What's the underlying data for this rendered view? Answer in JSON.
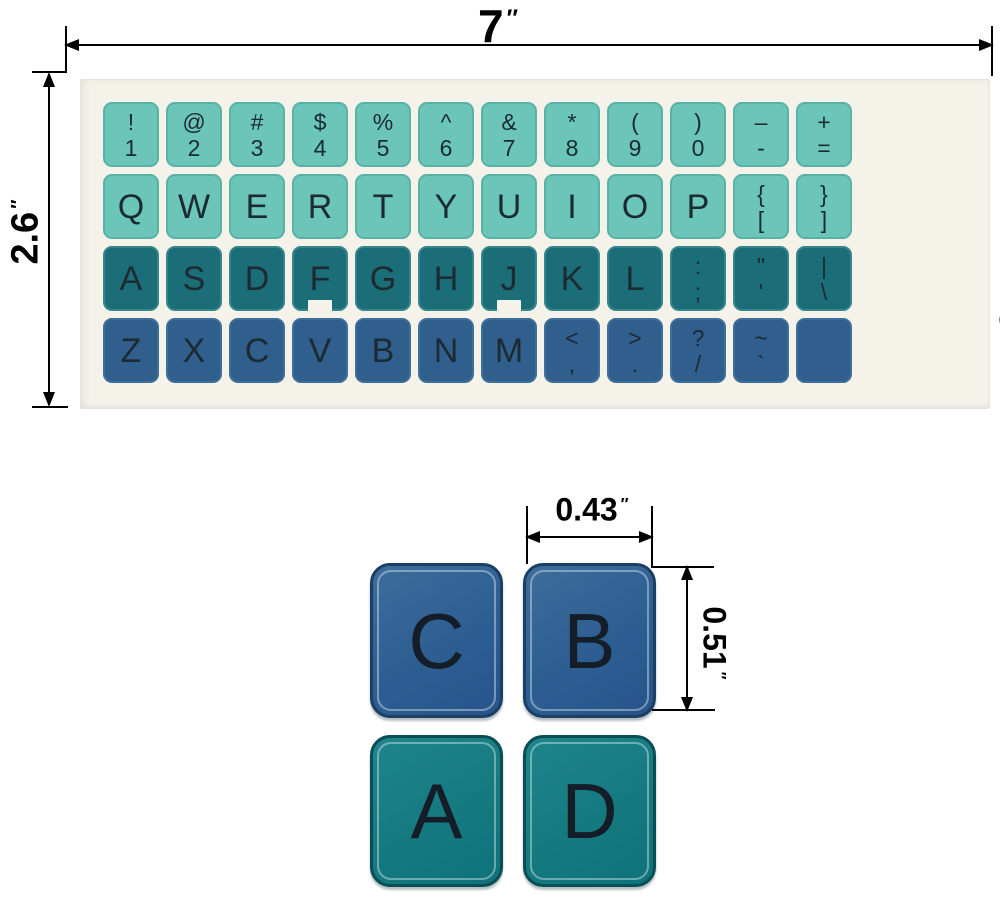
{
  "colors": {
    "sheet_bg": "#f5f2ea",
    "row_light": "#6cc5b9",
    "row_light_border": "#58b2a6",
    "row_dark": "#1b6d78",
    "row_dark_border": "#35858e",
    "row_blue": "#315f8d",
    "row_blue_border": "#3e6e9a",
    "big_blue": "#2d5e92",
    "big_blue_border": "#1c3f63",
    "big_teal": "#157a80",
    "big_teal_border": "#0b4d55",
    "legend_color": "#1c2a31"
  },
  "dimensions": {
    "sheet_width": {
      "value": "7",
      "unit": "″"
    },
    "sheet_height": {
      "value": "2.6",
      "unit": "″"
    },
    "key_width": {
      "value": "0.43",
      "unit": "″"
    },
    "key_height": {
      "value": "0.51",
      "unit": "″"
    }
  },
  "sticker_sheet": {
    "language_label": "English",
    "rows": [
      {
        "style": "light",
        "keys": [
          {
            "top": "!",
            "bottom": "1"
          },
          {
            "top": "@",
            "bottom": "2"
          },
          {
            "top": "#",
            "bottom": "3"
          },
          {
            "top": "$",
            "bottom": "4"
          },
          {
            "top": "%",
            "bottom": "5"
          },
          {
            "top": "^",
            "bottom": "6"
          },
          {
            "top": "&",
            "bottom": "7"
          },
          {
            "top": "*",
            "bottom": "8"
          },
          {
            "top": "(",
            "bottom": "9"
          },
          {
            "top": ")",
            "bottom": "0"
          },
          {
            "top": "–",
            "bottom": "-"
          },
          {
            "top": "+",
            "bottom": "="
          }
        ]
      },
      {
        "style": "light",
        "keys": [
          {
            "label": "Q"
          },
          {
            "label": "W"
          },
          {
            "label": "E"
          },
          {
            "label": "R"
          },
          {
            "label": "T"
          },
          {
            "label": "Y"
          },
          {
            "label": "U"
          },
          {
            "label": "I"
          },
          {
            "label": "O"
          },
          {
            "label": "P"
          },
          {
            "top": "{",
            "bottom": "["
          },
          {
            "top": "}",
            "bottom": "]"
          }
        ]
      },
      {
        "style": "dark",
        "keys": [
          {
            "label": "A"
          },
          {
            "label": "S"
          },
          {
            "label": "D"
          },
          {
            "label": "F",
            "notch": true
          },
          {
            "label": "G"
          },
          {
            "label": "H"
          },
          {
            "label": "J",
            "notch": true
          },
          {
            "label": "K"
          },
          {
            "label": "L"
          },
          {
            "top": ":",
            "bottom": ";"
          },
          {
            "top": "\"",
            "bottom": "'"
          },
          {
            "top": "|",
            "bottom": "\\"
          }
        ]
      },
      {
        "style": "blue",
        "keys": [
          {
            "label": "Z"
          },
          {
            "label": "X"
          },
          {
            "label": "C"
          },
          {
            "label": "V"
          },
          {
            "label": "B"
          },
          {
            "label": "N"
          },
          {
            "label": "M"
          },
          {
            "top": "<",
            "bottom": ","
          },
          {
            "top": ">",
            "bottom": "."
          },
          {
            "top": "?",
            "bottom": "/"
          },
          {
            "top": "~",
            "bottom": "`"
          },
          {
            "blank": true
          }
        ]
      }
    ]
  },
  "detail_figure": {
    "keys": [
      {
        "label": "C",
        "style": "blue"
      },
      {
        "label": "B",
        "style": "blue"
      },
      {
        "label": "A",
        "style": "teal"
      },
      {
        "label": "D",
        "style": "teal"
      }
    ]
  }
}
